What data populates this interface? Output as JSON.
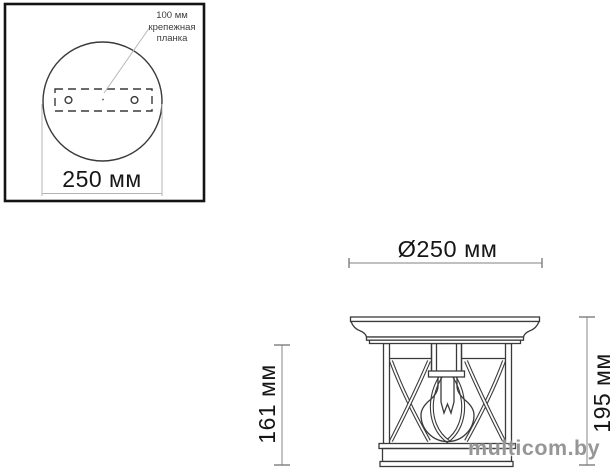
{
  "page": {
    "background": "#ffffff",
    "line_color": "#3a3a3a",
    "dim_line_color": "#9b9b9b",
    "frame_color": "#141414",
    "text_color": "#161616",
    "watermark_color": "#848484"
  },
  "top_view": {
    "name": "ceiling plate top view",
    "callout_label": "100 мм\nкрепежная\nпланка",
    "width_dimension": "250 мм"
  },
  "side_view": {
    "name": "ceiling lantern side view",
    "diameter_dimension": "Ø250 мм",
    "height_dimension_left": "161 мм",
    "height_dimension_right": "195 мм"
  },
  "watermark": {
    "text": "multicom.by"
  }
}
